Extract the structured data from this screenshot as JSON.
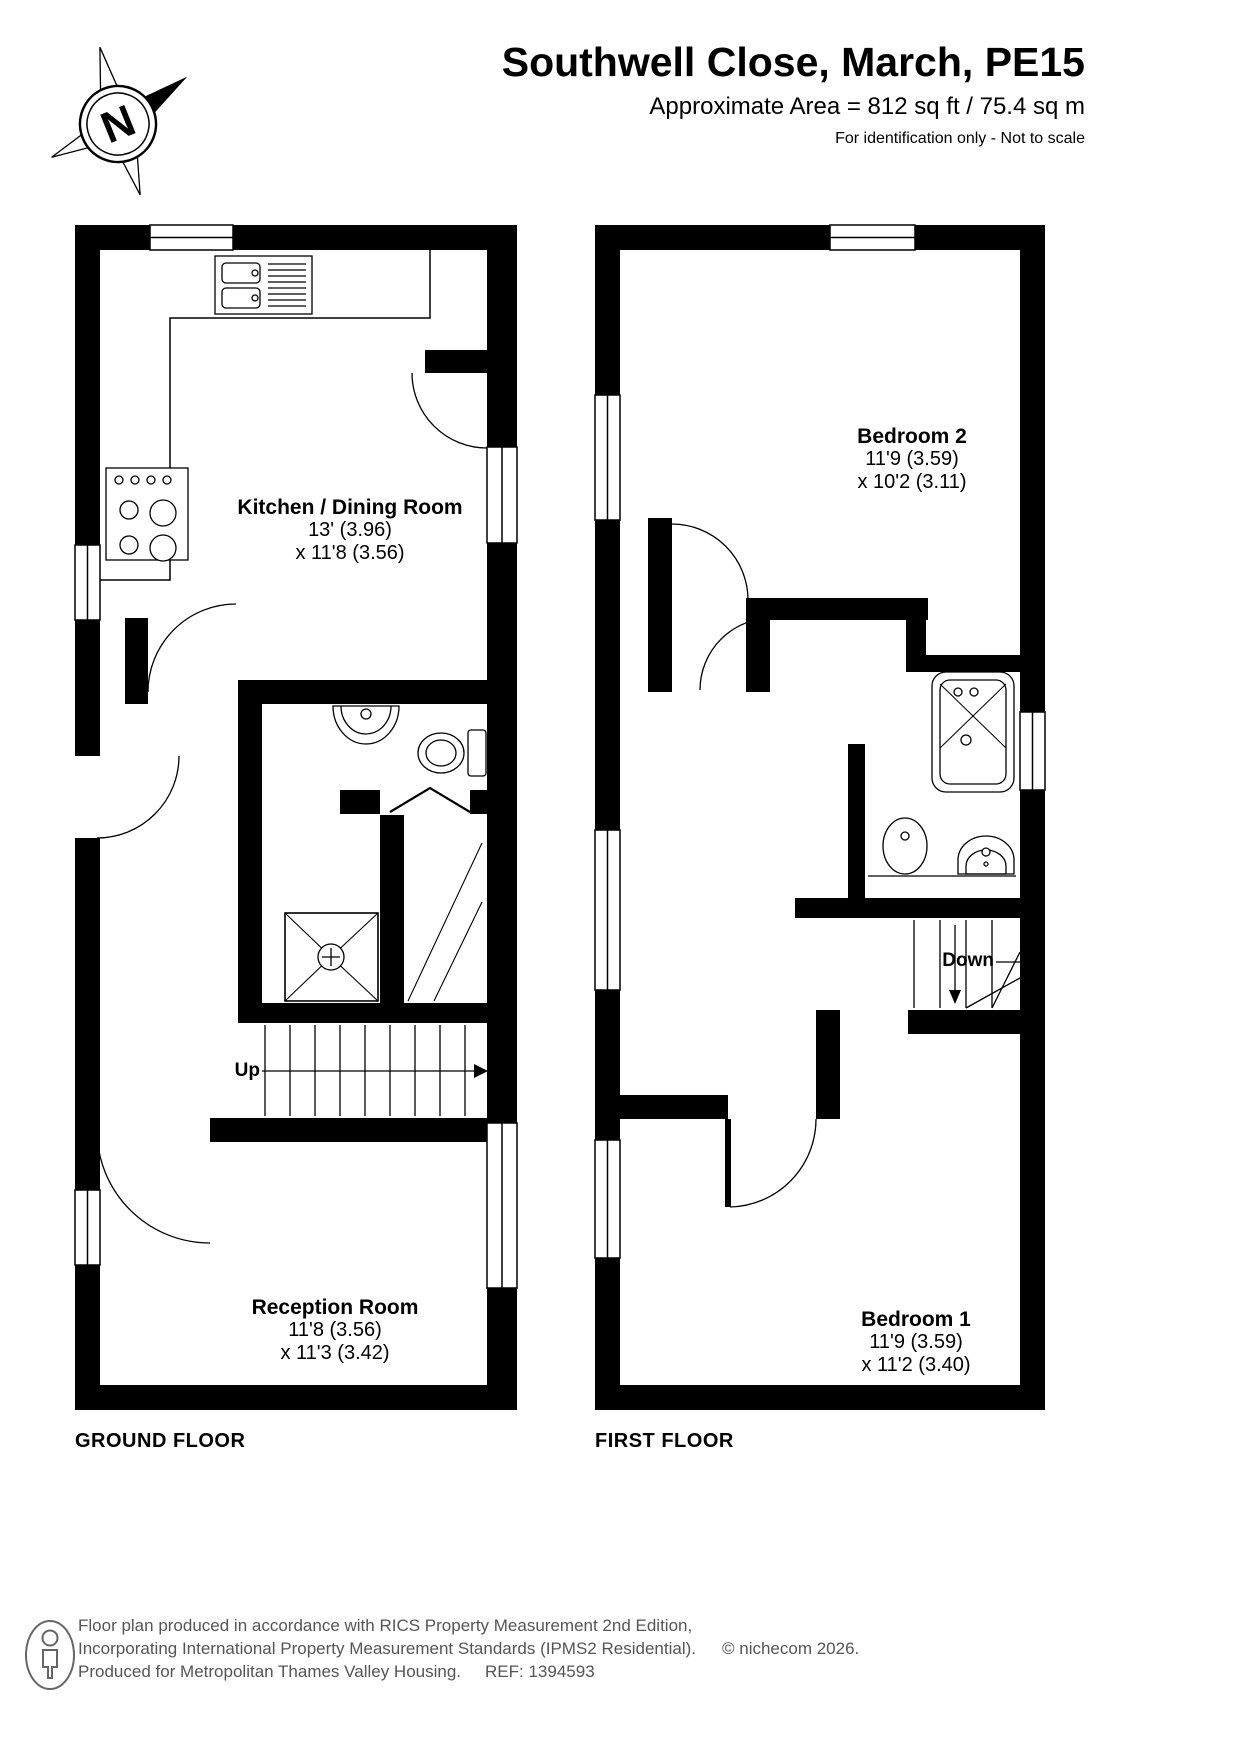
{
  "header": {
    "title": "Southwell Close, March, PE15",
    "area_line": "Approximate Area = 812 sq ft / 75.4 sq m",
    "disclaimer": "For identification only - Not to scale"
  },
  "compass": {
    "direction_label": "N"
  },
  "ground_floor": {
    "floor_label": "GROUND FLOOR",
    "stairs_label": "Up",
    "rooms": [
      {
        "name": "Kitchen / Dining Room",
        "dim1": "13' (3.96)",
        "dim2": "x 11'8 (3.56)"
      },
      {
        "name": "Reception Room",
        "dim1": "11'8 (3.56)",
        "dim2": "x 11'3 (3.42)"
      }
    ]
  },
  "first_floor": {
    "floor_label": "FIRST FLOOR",
    "stairs_label": "Down",
    "rooms": [
      {
        "name": "Bedroom 2",
        "dim1": "11'9 (3.59)",
        "dim2": "x 10'2 (3.11)"
      },
      {
        "name": "Bedroom 1",
        "dim1": "11'9 (3.59)",
        "dim2": "x 11'2 (3.40)"
      }
    ]
  },
  "footer": {
    "line1": "Floor plan produced in accordance with RICS Property Measurement 2nd Edition,",
    "line2": "Incorporating International Property Measurement Standards (IPMS2 Residential).",
    "copyright": "© nichecom 2026.",
    "line3": "Produced for Metropolitan Thames Valley Housing.",
    "ref": "REF: 1394593"
  },
  "colors": {
    "wall": "#000000",
    "footer_text": "#555555"
  }
}
